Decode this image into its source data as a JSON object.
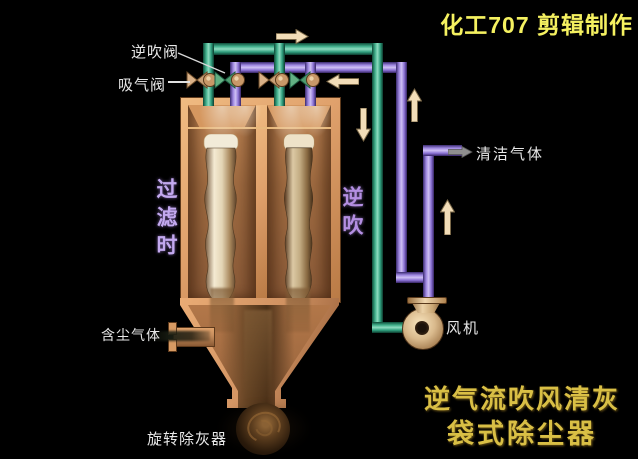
{
  "title": {
    "text": "化工707 剪辑制作"
  },
  "caption": {
    "line1": "逆气流吹风清灰",
    "line2": "袋式除尘器"
  },
  "labels": {
    "reverse_blow_valve": "逆吹阀",
    "suction_valve": "吸气阀",
    "clean_gas": "清洁气体",
    "fan": "风机",
    "dusty_gas": "含尘气体",
    "rotary_ash_remover": "旋转除灰器",
    "state_filtering": "过滤时",
    "state_reverse_blow": "逆吹"
  },
  "colors": {
    "background": "#000000",
    "suction_pipe_green": "#2f9e7d",
    "blow_pipe_purple": "#8b72d4",
    "housing_tan": "#dfa06b",
    "title_yellow": "#f5f160",
    "caption_gold": "#d9bf45",
    "label_white": "#e8e8e8",
    "state_filtering_color": "#c3a9ef",
    "state_blow_color": "#b48fe2",
    "arrow_cream": "#f2ddb8"
  },
  "icons": {
    "arrows": [
      "flow-arrow-right-icon",
      "flow-arrow-left-icon",
      "flow-arrow-down-icon",
      "flow-arrow-up-icon",
      "flow-arrow-up-clean-icon",
      "clean-gas-pointer-icon"
    ]
  }
}
